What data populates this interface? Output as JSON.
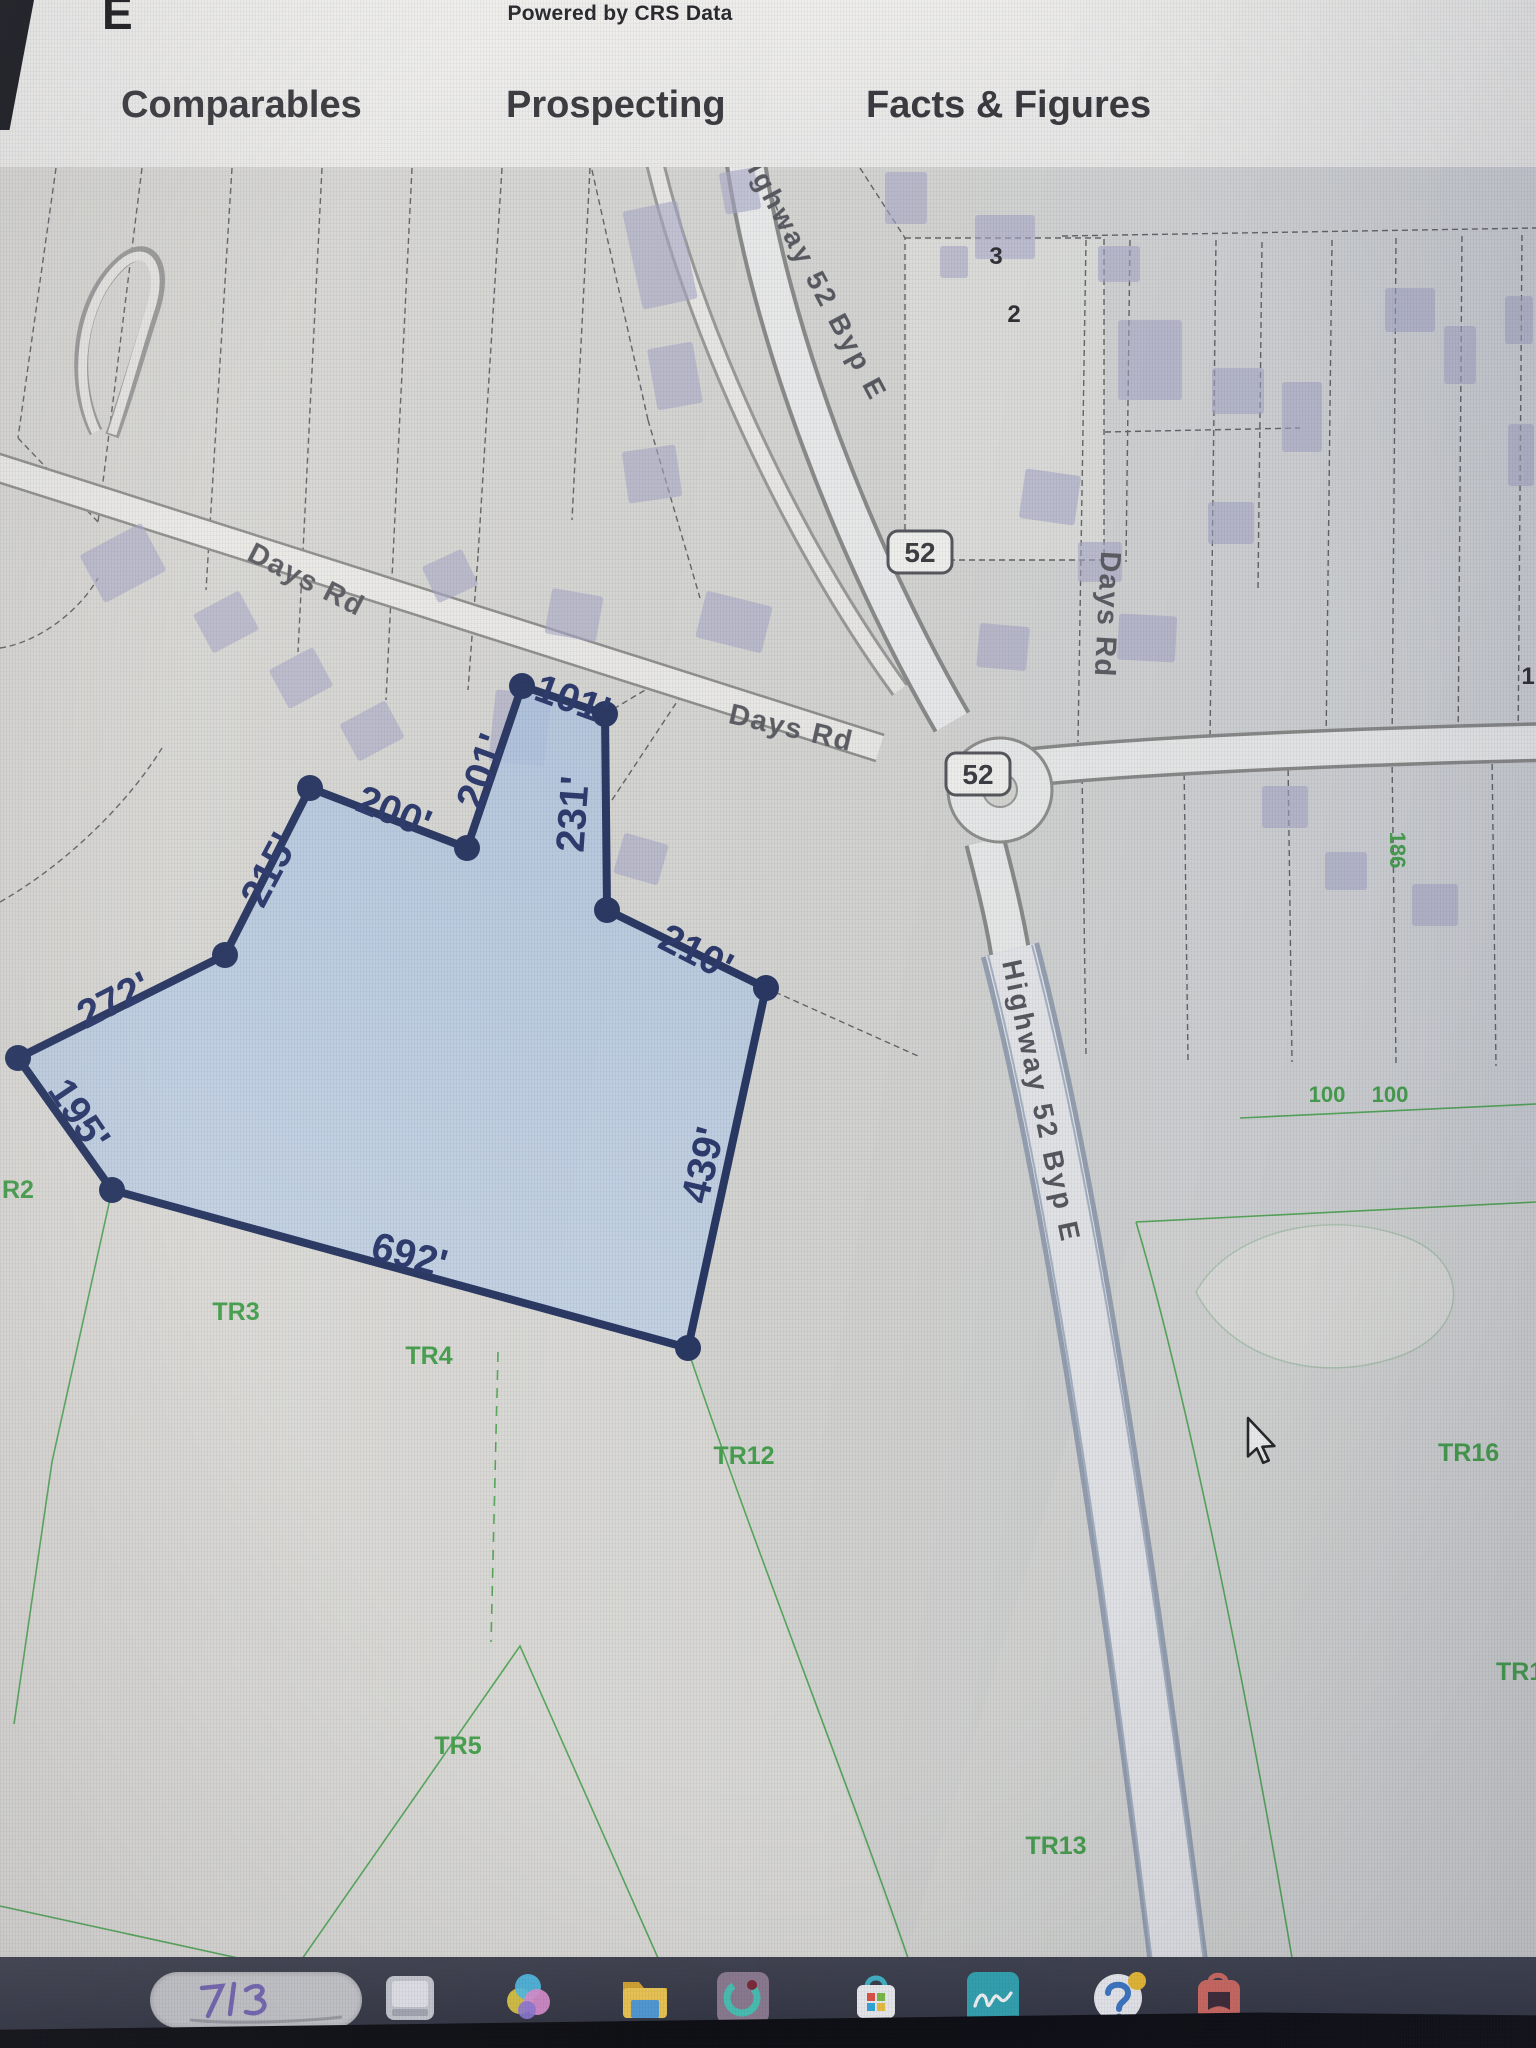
{
  "header": {
    "partial_letter_top": "E",
    "powered_by": "Powered by CRS Data",
    "partial_tab": "t",
    "tabs": [
      {
        "label": "Comparables"
      },
      {
        "label": "Prospecting"
      },
      {
        "label": "Facts & Figures"
      }
    ]
  },
  "map": {
    "parcel_dimensions": [
      {
        "text": "101'"
      },
      {
        "text": "201'"
      },
      {
        "text": "231'"
      },
      {
        "text": "200'"
      },
      {
        "text": "215'"
      },
      {
        "text": "272'"
      },
      {
        "text": "195'"
      },
      {
        "text": "692'"
      },
      {
        "text": "439'"
      },
      {
        "text": "210'"
      }
    ],
    "roads": {
      "days_rd_west": "Days Rd",
      "days_rd_center": "Days Rd",
      "days_rd_east": "Days Rd",
      "highway_north": "Highway 52 Byp E",
      "highway_south": "Highway 52 Byp E"
    },
    "route_shields": [
      {
        "text": "52"
      },
      {
        "text": "52"
      }
    ],
    "tracts": [
      {
        "text": "R2"
      },
      {
        "text": "TR3"
      },
      {
        "text": "TR4"
      },
      {
        "text": "TR12"
      },
      {
        "text": "TR5"
      },
      {
        "text": "TR13"
      },
      {
        "text": "TR16"
      },
      {
        "text": "TR1"
      }
    ],
    "green_numbers": [
      {
        "text": "100"
      },
      {
        "text": "100"
      },
      {
        "text": "186"
      }
    ],
    "black_numbers": [
      {
        "text": "2"
      },
      {
        "text": "3"
      },
      {
        "text": "1"
      }
    ],
    "colors": {
      "parcel_fill": "#b7cde6",
      "parcel_outline": "#24335f",
      "tract_green": "#44a04a",
      "dimension_navy": "#273569"
    }
  },
  "taskbar": {
    "icons": [
      {
        "name": "search-pill-scribble"
      },
      {
        "name": "window-app"
      },
      {
        "name": "photos-pinwheel"
      },
      {
        "name": "file-explorer-folder"
      },
      {
        "name": "teal-swirl-tile"
      },
      {
        "name": "microsoft-store-bag"
      },
      {
        "name": "teal-cursive-app"
      },
      {
        "name": "help-circle"
      },
      {
        "name": "red-shield-bag"
      }
    ]
  }
}
